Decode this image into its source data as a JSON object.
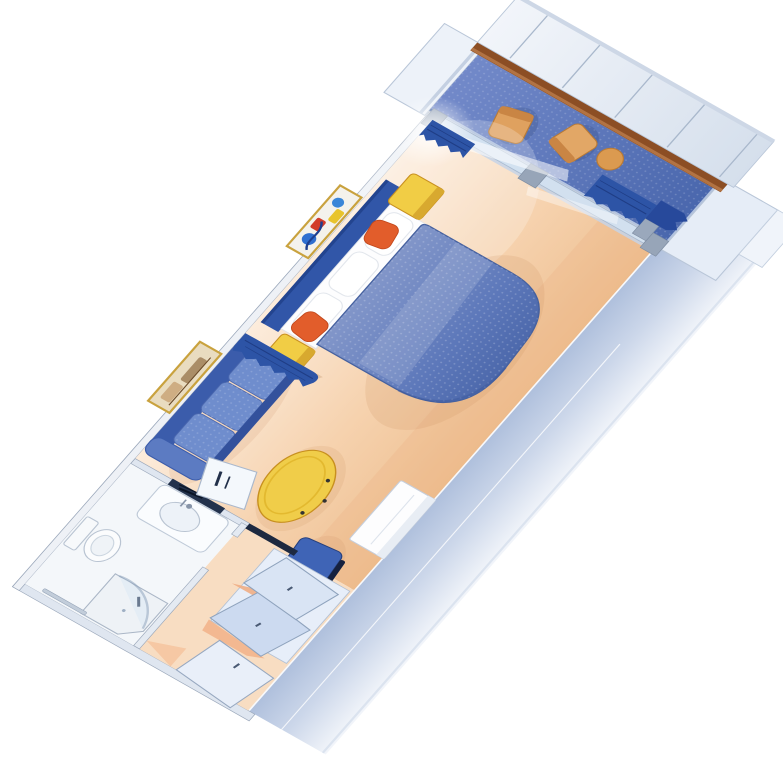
{
  "scene": {
    "title": "Cruise ship balcony stateroom — isometric cutaway floor plan",
    "background": "#ffffff"
  },
  "palette": {
    "floor_peach": "#f6d2ae",
    "floor_light": "#fcecdc",
    "entry_floor": "#f8ddc2",
    "bath_floor": "#f4f7fa",
    "deck_blue": "#5d7cc3",
    "bed_blue": "#6a84c2",
    "bed_dark": "#4c68ab",
    "headboard_blue": "#3156a8",
    "curtain_blue": "#2d54a6",
    "curtain_dark": "#1f3d85",
    "sofa_blue": "#6f8dcd",
    "sofa_base": "#3b5cab",
    "sofa_arm": "#5c7bc2",
    "accent_yellow": "#f1cd45",
    "accent_yellow_dark": "#d8a92f",
    "accent_orange": "#e25d2b",
    "wood_rail": "#8c4e24",
    "wood_rail_light": "#b27343",
    "wall_band": "#b3c2dd",
    "wall_light": "#e9eef7",
    "glass": "#d4e4f4",
    "frame_gray": "#97a5b8",
    "chair_blue": "#3f64b6",
    "chair_navy": "#1d2c52",
    "tan_chair": "#dfa15f",
    "tan_chair_dark": "#c98544",
    "mirror_dark": "#23324c",
    "art_gold_frame": "#c9a23e",
    "fixture_white": "#fafcfe",
    "white": "#ffffff"
  },
  "rooms": [
    {
      "id": "cabin",
      "label": "Main cabin"
    },
    {
      "id": "bathroom",
      "label": "Bathroom"
    },
    {
      "id": "entry",
      "label": "Entry and wardrobe"
    },
    {
      "id": "balcony",
      "label": "Private balcony"
    }
  ],
  "furniture": [
    {
      "id": "bed",
      "label": "Bed with blue quilted spread and rounded foot"
    },
    {
      "id": "pillows",
      "label": "White pillows at headboard"
    },
    {
      "id": "headboard",
      "label": "Blue headboard panel"
    },
    {
      "id": "nightstand-left",
      "label": "Yellow nightstand (room side)"
    },
    {
      "id": "nightstand-right",
      "label": "Yellow nightstand (window side)"
    },
    {
      "id": "cushion-left",
      "label": "Orange accent cushion (room side)"
    },
    {
      "id": "cushion-right",
      "label": "Orange accent cushion (window side)"
    },
    {
      "id": "sofa",
      "label": "Blue three-seat sofa"
    },
    {
      "id": "coffee-table",
      "label": "Yellow oval coffee table"
    },
    {
      "id": "vanity-desk",
      "label": "White vanity cabinet"
    },
    {
      "id": "desk-chair",
      "label": "Blue desk chair"
    },
    {
      "id": "artwork-abstract",
      "label": "Abstract framed artwork above bed"
    },
    {
      "id": "artwork-landscape",
      "label": "Framed landscape artwork above sofa"
    },
    {
      "id": "room-divider-curtain",
      "label": "Blue pleated room-divider curtain"
    },
    {
      "id": "glass-partition",
      "label": "Floor-to-ceiling glass partition with sliding door"
    },
    {
      "id": "balcony-curtain-port",
      "label": "Balcony curtain, port side"
    },
    {
      "id": "balcony-curtain-starboard",
      "label": "Balcony curtain, starboard side"
    },
    {
      "id": "balcony-chair-1",
      "label": "Balcony chair"
    },
    {
      "id": "balcony-chair-2",
      "label": "Balcony chair"
    },
    {
      "id": "balcony-table",
      "label": "Balcony side table"
    },
    {
      "id": "balcony-railing",
      "label": "Balcony railing with wood cap"
    },
    {
      "id": "shower",
      "label": "Corner shower with curved glass"
    },
    {
      "id": "toilet",
      "label": "Toilet"
    },
    {
      "id": "sink",
      "label": "Vanity sink"
    },
    {
      "id": "bathroom-mirror",
      "label": "Bathroom mirror shelf"
    },
    {
      "id": "closet-doors",
      "label": "Open wardrobe doors"
    },
    {
      "id": "entry-door",
      "label": "Entry door"
    }
  ]
}
